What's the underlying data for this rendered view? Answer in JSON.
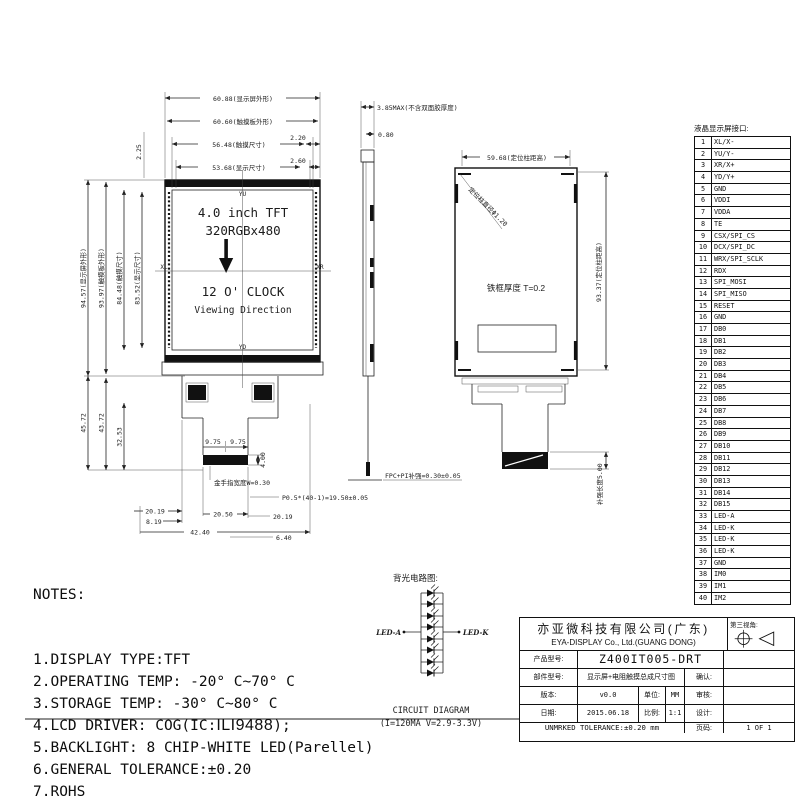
{
  "front_view": {
    "dim_top": [
      "60.88(显示屏外形)",
      "60.60(触摸板外形)",
      "56.48(触摸尺寸)",
      "53.68(显示尺寸)"
    ],
    "dim_margin_1": "2.20",
    "dim_margin_2": "2.60",
    "dim_side_small": "2.25",
    "corner_yu": "YU",
    "corner_yd": "YD",
    "corner_xl": "XL",
    "corner_xr": "XR",
    "center_line_1": "4.0 inch TFT",
    "center_line_2": "320RGBx480",
    "clock_line_1": "12 O' CLOCK",
    "clock_line_2": "Viewing Direction",
    "dim_left": [
      "94.57(显示屏外形)",
      "93.97(触摸板外形)",
      "84.48(触摸尺寸)",
      "83.52(显示尺寸)"
    ],
    "dim_lower_left": [
      "45.72",
      "43.72",
      "32.53"
    ],
    "dim_975a": "9.75",
    "dim_975b": "9.75",
    "dim_400": "4.00",
    "gold_finger_note": "金手指宽度W=0.30",
    "dim_2019_left": "20.19",
    "dim_2050": "20.50",
    "dim_819": "8.19",
    "dim_4240": "42.40",
    "pitch_note": "P0.5*(40-1)=19.50±0.05",
    "dim_2019_right": "20.19",
    "dim_640": "6.40"
  },
  "side_view": {
    "dim_thickness": "3.85MAX(不含双面胶厚度)",
    "dim_gap": "0.80",
    "fpc_note": "FPC+PI补强=0.30±0.05"
  },
  "back_view": {
    "dim_top": "59.68(定位柱距高)",
    "post_note": "定位柱直径Φ1.20",
    "frame_note": "铁框厚度 T=0.2",
    "dim_right": "93.37(定位柱距高)",
    "stiffener_note": "补强长度5.00"
  },
  "pin_table": {
    "title": "液晶显示屏接口:",
    "pins": [
      [
        "1",
        "XL/X-"
      ],
      [
        "2",
        "YU/Y-"
      ],
      [
        "3",
        "XR/X+"
      ],
      [
        "4",
        "YD/Y+"
      ],
      [
        "5",
        "GND"
      ],
      [
        "6",
        "VDDI"
      ],
      [
        "7",
        "VDDA"
      ],
      [
        "8",
        "TE"
      ],
      [
        "9",
        "CSX/SPI_CS"
      ],
      [
        "10",
        "DCX/SPI_DC"
      ],
      [
        "11",
        "WRX/SPI_SCLK"
      ],
      [
        "12",
        "RDX"
      ],
      [
        "13",
        "SPI_MOSI"
      ],
      [
        "14",
        "SPI_MISO"
      ],
      [
        "15",
        "RESET"
      ],
      [
        "16",
        "GND"
      ],
      [
        "17",
        "DB0"
      ],
      [
        "18",
        "DB1"
      ],
      [
        "19",
        "DB2"
      ],
      [
        "20",
        "DB3"
      ],
      [
        "21",
        "DB4"
      ],
      [
        "22",
        "DB5"
      ],
      [
        "23",
        "DB6"
      ],
      [
        "24",
        "DB7"
      ],
      [
        "25",
        "DB8"
      ],
      [
        "26",
        "DB9"
      ],
      [
        "27",
        "DB10"
      ],
      [
        "28",
        "DB11"
      ],
      [
        "29",
        "DB12"
      ],
      [
        "30",
        "DB13"
      ],
      [
        "31",
        "DB14"
      ],
      [
        "32",
        "DB15"
      ],
      [
        "33",
        "LED-A"
      ],
      [
        "34",
        "LED-K"
      ],
      [
        "35",
        "LED-K"
      ],
      [
        "36",
        "LED-K"
      ],
      [
        "37",
        "GND"
      ],
      [
        "38",
        "IM0"
      ],
      [
        "39",
        "IM1"
      ],
      [
        "40",
        "IM2"
      ]
    ]
  },
  "notes": {
    "header": "NOTES:",
    "lines": [
      "1.DISPLAY TYPE:TFT",
      "2.OPERATING TEMP: -20° C~70° C",
      "3.STORAGE TEMP: -30° C~80° C",
      {
        "prefix": "4.LCD DRIVER: COG(IC:",
        "ic": "ILI9488",
        "suffix": ");"
      },
      "5.BACKLIGHT: 8 CHIP-WHITE LED(Parellel)",
      "6.GENERAL TOLERANCE:±0.20",
      "7.ROHS"
    ]
  },
  "backlight": {
    "title": "背光电路图:",
    "anode": "LED-A",
    "cathode": "LED-K",
    "caption_1": "CIRCUIT DIAGRAM",
    "caption_2": "(I=120MA V=2.9-3.3V)"
  },
  "title_block": {
    "company_cn": "亦亚微科技有限公司(广东)",
    "company_en": "EYA-DISPLAY Co., Ltd.(GUANG DONG)",
    "angle_label": "第三视角:",
    "product_label": "产品型号:",
    "product_value": "Z400IT005-DRT",
    "part_label": "部件型号:",
    "part_value": "显示屏+电阻触摸总成尺寸图",
    "confirm_label": "确认:",
    "version_label": "版本:",
    "version_value": "v0.0",
    "unit_label": "单位:",
    "unit_value": "MM",
    "review_label": "审核:",
    "date_label": "日期:",
    "date_value": "2015.06.18",
    "scale_label": "比例:",
    "scale_value": "1:1",
    "design_label": "设计:",
    "tolerance": "UNMRKED TOLERANCE:±0.20 mm",
    "page_label": "页码:",
    "page_value": "1 OF 1"
  }
}
